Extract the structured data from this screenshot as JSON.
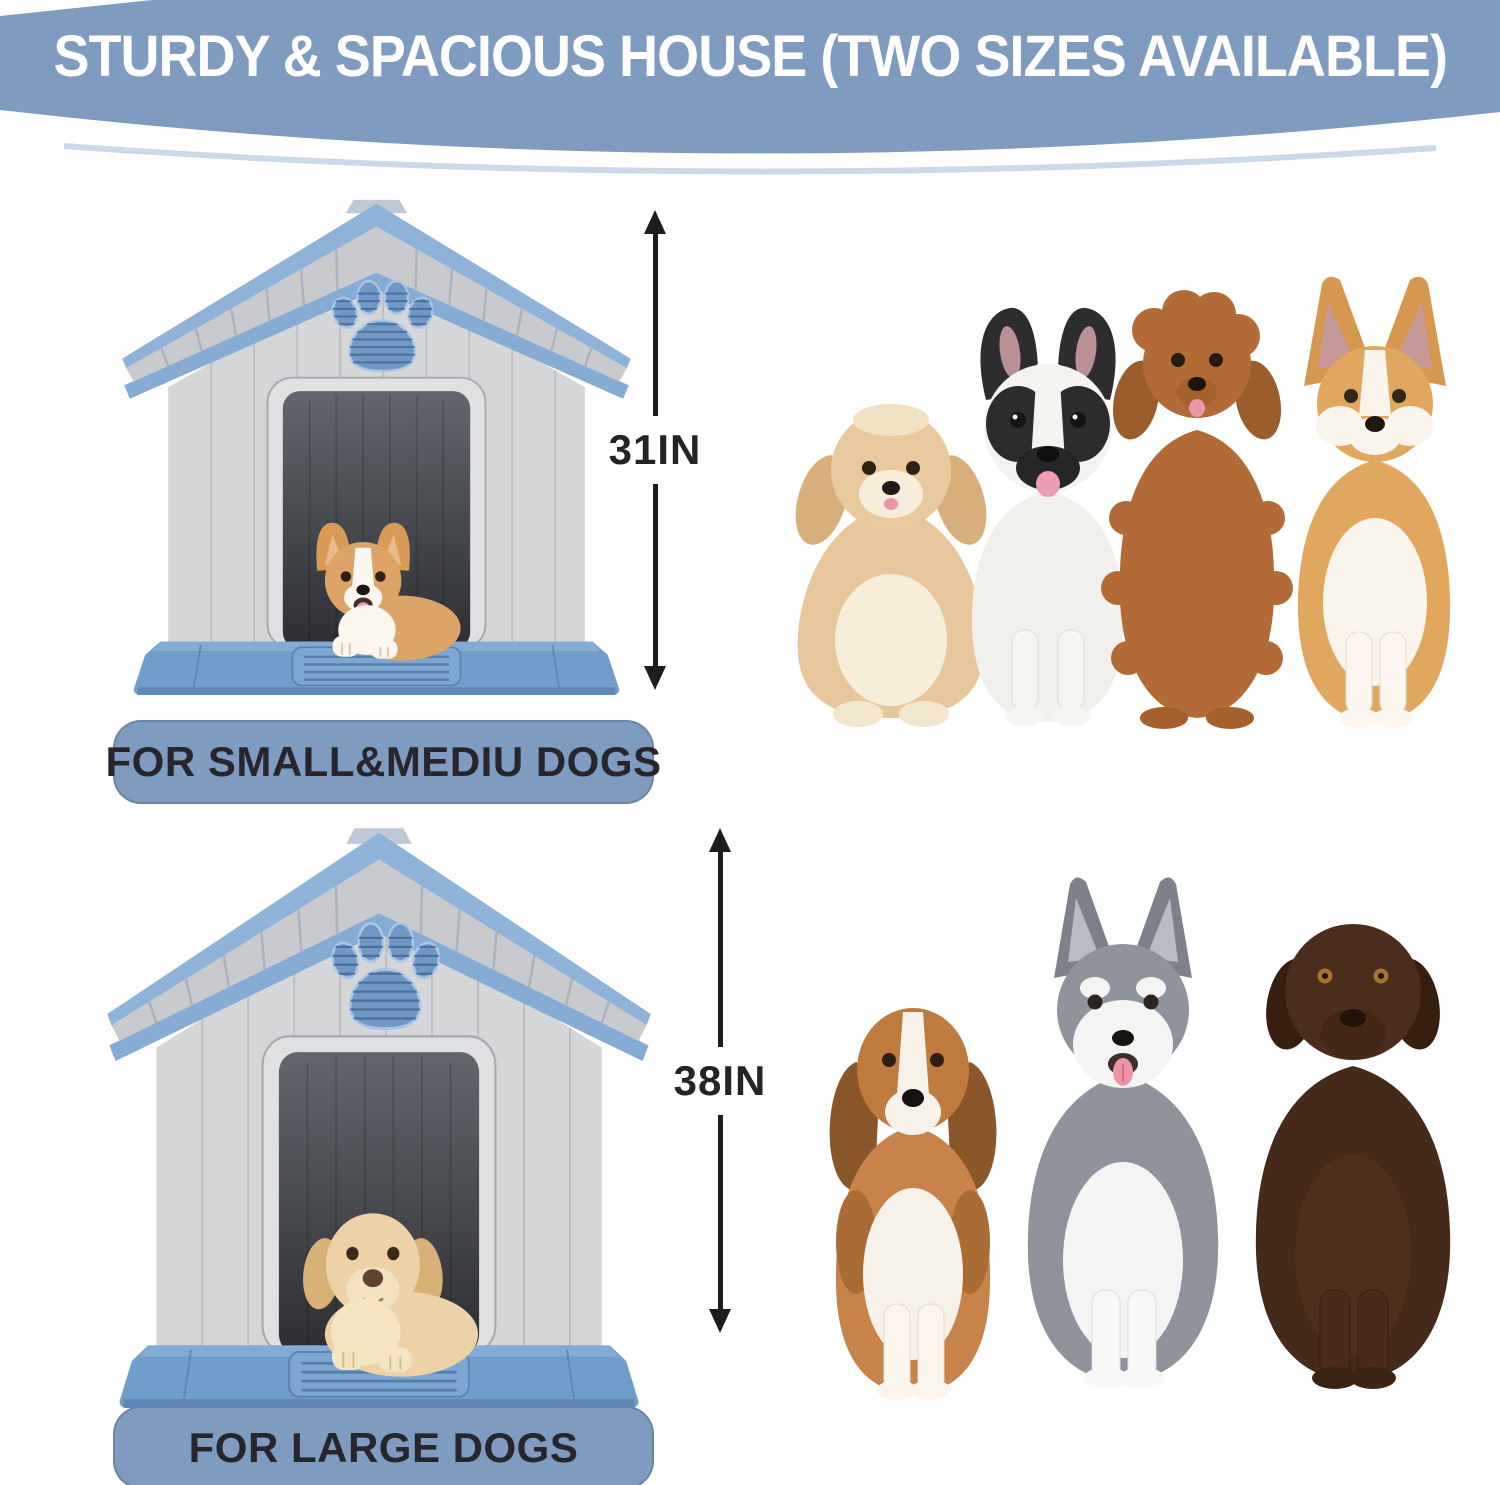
{
  "banner": {
    "title": "STURDY & SPACIOUS HOUSE (TWO SIZES AVAILABLE)",
    "bg_color": "#7f9cc0",
    "text_color": "#ffffff"
  },
  "small_section": {
    "dimension_label": "31IN",
    "size_label": "FOR SMALL&MEDIU DOGS",
    "house_occupant": "corgi-puppy",
    "dog_breeds": [
      "havanese",
      "french-bulldog",
      "toy-poodle",
      "corgi"
    ]
  },
  "large_section": {
    "dimension_label": "38IN",
    "size_label": "FOR LARGE DOGS",
    "house_occupant": "yellow-labrador-puppy",
    "dog_breeds": [
      "beagle",
      "husky",
      "chocolate-labrador"
    ]
  },
  "colors": {
    "banner_blue": "#7f9cc0",
    "roof_trim_blue": "#8fb2d8",
    "base_blue": "#6f9ecb",
    "wall_gray": "#d5d6d8",
    "label_text": "#26262c",
    "dimension_text": "#242424"
  }
}
